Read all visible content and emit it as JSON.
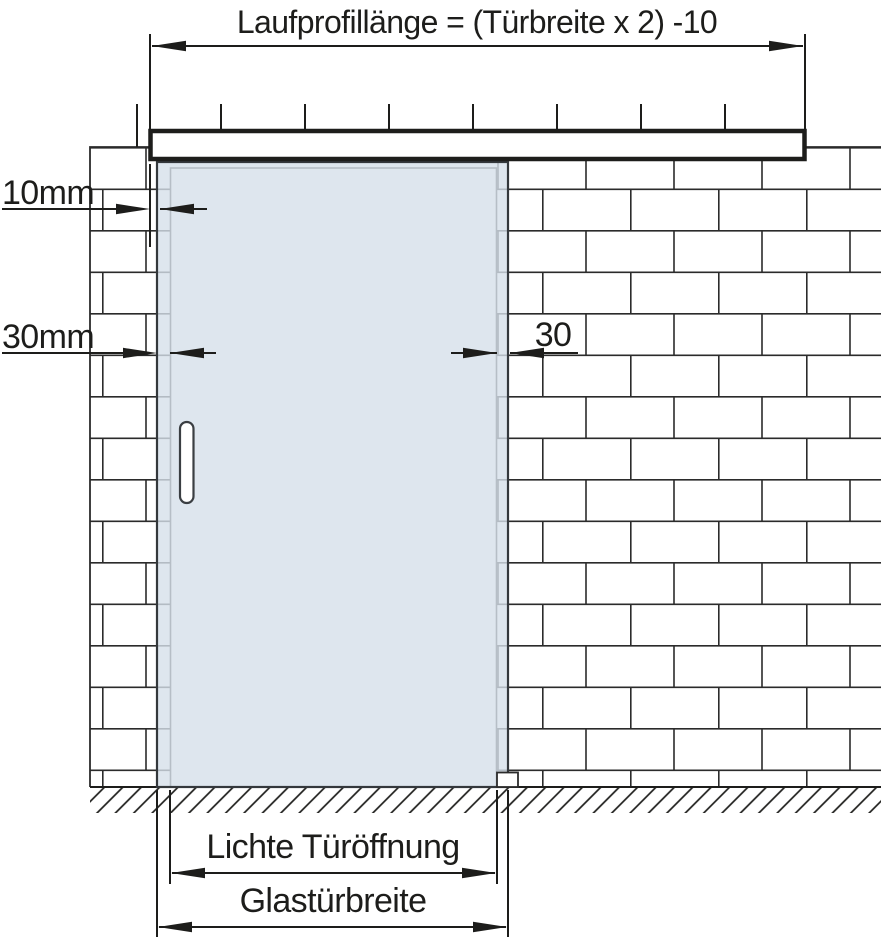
{
  "diagram": {
    "title": "Laufprofillänge = (Türbreite x 2) -10",
    "labels": {
      "track_to_glass_gap": "10mm",
      "wall_overlap_left": "30mm",
      "wall_overlap_right": "30",
      "clear_opening": "Lichte Türöffnung",
      "glass_door_width": "Glastürbreite"
    },
    "colors": {
      "glass": "#d6e0ea",
      "line": "#1d1d1b",
      "background": "#ffffff"
    }
  }
}
